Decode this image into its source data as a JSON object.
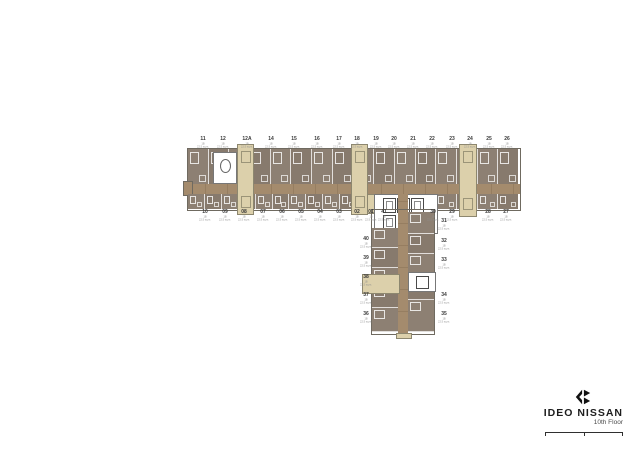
{
  "brand": {
    "name": "IDEO NISSAN",
    "floor": "10th Floor"
  },
  "unit_sub": {
    "line1": "1B",
    "line2": "22.5 sq.m."
  },
  "plan": {
    "top_row": [
      "11",
      "12",
      "12A",
      "14",
      "15",
      "16",
      "17",
      "18",
      "19",
      "20",
      "21",
      "22",
      "23",
      "24",
      "25",
      "26"
    ],
    "bottom_row": [
      "10",
      "09",
      "08",
      "07",
      "06",
      "05",
      "04",
      "03",
      "02",
      "01",
      "41"
    ],
    "bottom_right_row": [
      "30",
      "29",
      "28",
      "27"
    ],
    "wing_left": [
      "40",
      "39",
      "38",
      "37",
      "36"
    ],
    "wing_right": [
      "31",
      "32",
      "33",
      "34",
      "35"
    ]
  },
  "colors": {
    "unit": "#8d8073",
    "unit_alt": "#877a6d",
    "corridor": "#a48b6d",
    "stair_cream": "#dcd0ab",
    "outline": "#6f6a60",
    "background": "#ffffff"
  }
}
